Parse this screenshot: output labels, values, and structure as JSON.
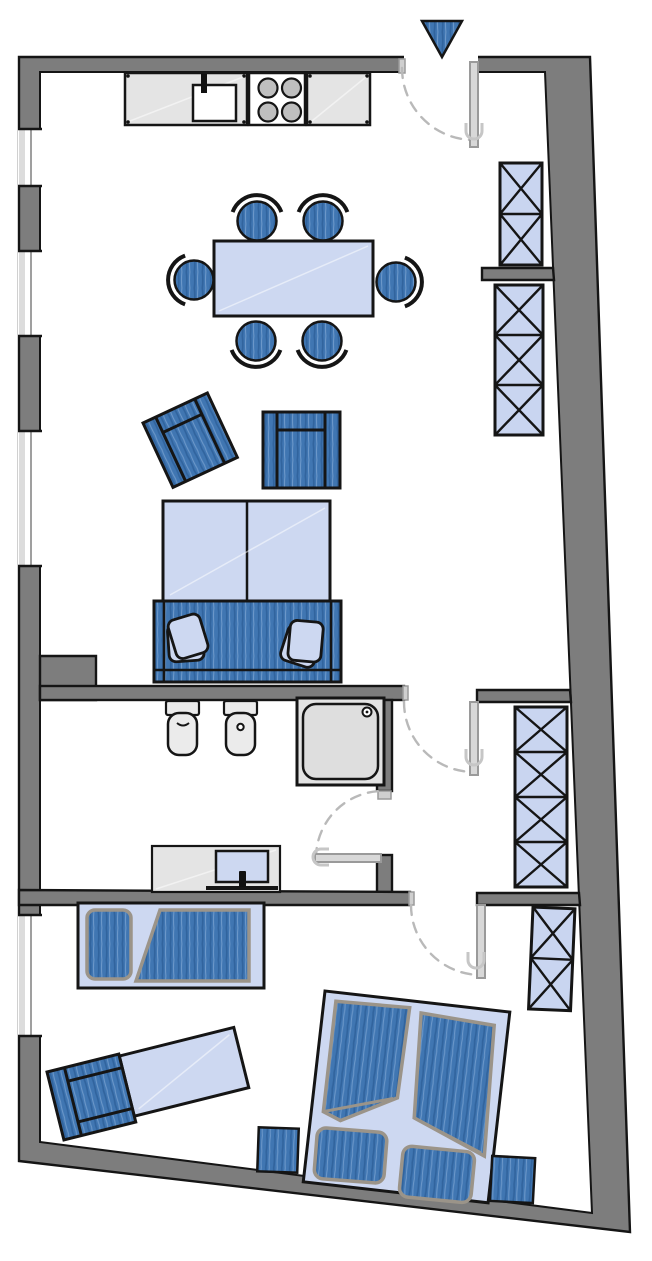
{
  "floor_plan": {
    "type": "apartment-floor-plan",
    "orientation": "entrance-at-top",
    "colors": {
      "wall": "#7d7d7d",
      "outline": "#151515",
      "floor": "#ffffff",
      "dark_furniture": "#4076b2",
      "dark_furniture_hatch": "#31649e",
      "dark_furniture_hatch_light": "#6b97c9",
      "light_furniture": "#cdd8f1",
      "wardrobe": "#c9d5f0",
      "counter": "#e4e4e4",
      "fixture": "#ebebeb",
      "shower_tray": "#dedede",
      "burner": "#bfbfbf",
      "door_leaf": "#d8d8d8",
      "door_swing": "#b9b9b9",
      "textile_edge": "#9b9489",
      "window_glass": "#ffffff",
      "window_frame": "#9f9f9f"
    },
    "rooms": [
      {
        "name": "kitchen-living-room"
      },
      {
        "name": "bathroom"
      },
      {
        "name": "hallway"
      },
      {
        "name": "bedroom"
      }
    ],
    "windows": 4,
    "doors": {
      "entry": 1,
      "interior": 3
    },
    "entrance_symbol": "blue-triangle-arrow-down",
    "furniture": [
      {
        "name": "kitchen-counter-with-sink",
        "count": 1
      },
      {
        "name": "stove-four-burners",
        "count": 1
      },
      {
        "name": "kitchen-counter",
        "count": 1
      },
      {
        "name": "dining-table",
        "count": 1
      },
      {
        "name": "dining-chair",
        "count": 6
      },
      {
        "name": "armchair",
        "count": 3
      },
      {
        "name": "sofa-bed",
        "count": 1
      },
      {
        "name": "sofa-cushion",
        "count": 2
      },
      {
        "name": "wardrobe",
        "count": 4,
        "sections": [
          2,
          3,
          4,
          2
        ]
      },
      {
        "name": "toilet",
        "count": 1
      },
      {
        "name": "bidet",
        "count": 1
      },
      {
        "name": "shower",
        "count": 1
      },
      {
        "name": "washbasin-vanity",
        "count": 1
      },
      {
        "name": "single-bed",
        "count": 1
      },
      {
        "name": "chaise-longue",
        "count": 1
      },
      {
        "name": "double-bed",
        "count": 1
      },
      {
        "name": "stool",
        "count": 2
      }
    ]
  }
}
